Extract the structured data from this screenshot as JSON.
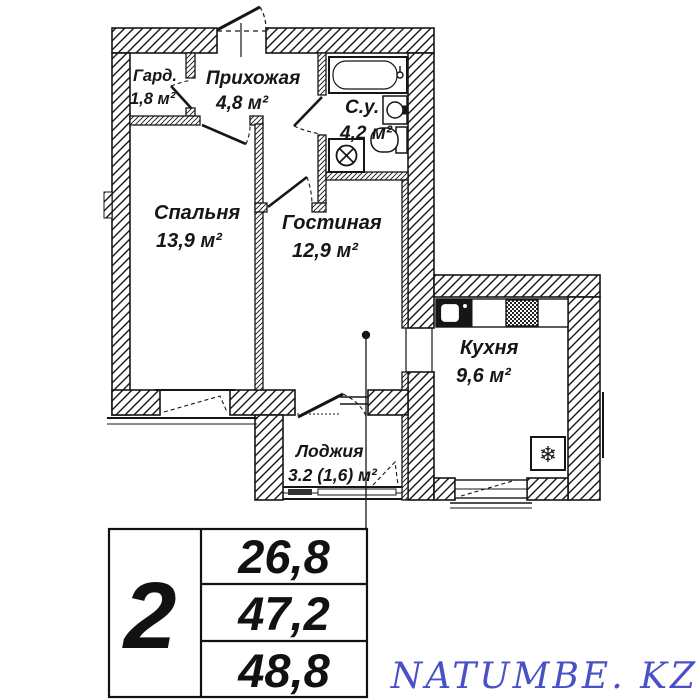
{
  "plan": {
    "rooms": [
      {
        "name": "Гард.",
        "area": "1,8 м²"
      },
      {
        "name": "Прихожая",
        "area": "4,8 м²"
      },
      {
        "name": "С.у.",
        "area": "4,2 м²"
      },
      {
        "name": "Спальня",
        "area": "13,9 м²"
      },
      {
        "name": "Гостиная",
        "area": "12,9 м²"
      },
      {
        "name": "Кухня",
        "area": "9,6 м²"
      },
      {
        "name": "Лоджия",
        "area": "3.2 (1,6) м²"
      }
    ],
    "line_color": "#161616"
  },
  "summary_table": {
    "rooms_count": "2",
    "rows": [
      "26,8",
      "47,2",
      "48,8"
    ]
  },
  "watermark": {
    "text": "NATUMBE. KZ",
    "color": "#4a50c8"
  }
}
